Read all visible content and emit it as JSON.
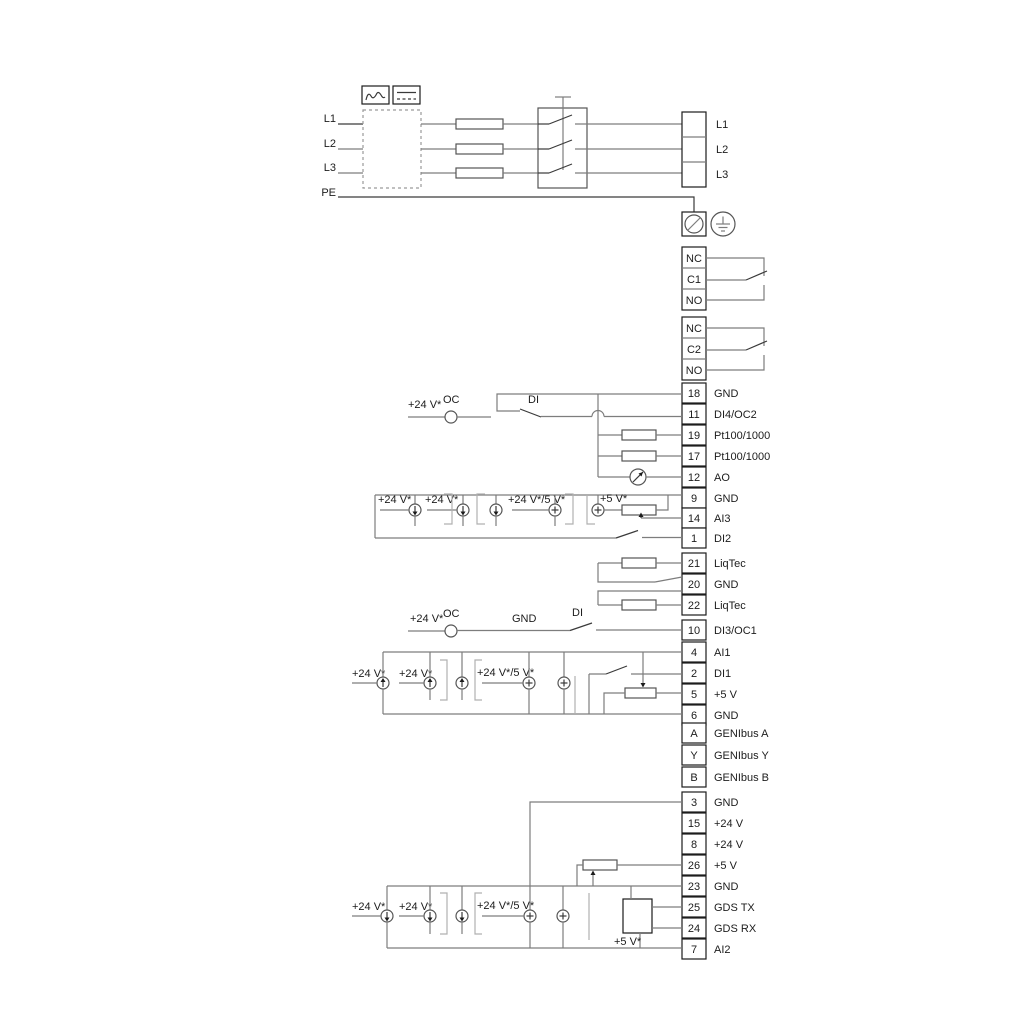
{
  "power": {
    "inputs": {
      "l1": "L1",
      "l2": "L2",
      "l3": "L3",
      "pe": "PE"
    },
    "out_terminals": {
      "l1": "L1",
      "l2": "L2",
      "l3": "L3"
    }
  },
  "relays": {
    "r1": {
      "nc": "NC",
      "c": "C1",
      "no": "NO"
    },
    "r2": {
      "nc": "NC",
      "c": "C2",
      "no": "NO"
    }
  },
  "io_terminals": [
    {
      "num": "18",
      "label": "GND"
    },
    {
      "num": "11",
      "label": "DI4/OC2"
    },
    {
      "num": "19",
      "label": "Pt100/1000"
    },
    {
      "num": "17",
      "label": "Pt100/1000"
    },
    {
      "num": "12",
      "label": "AO"
    },
    {
      "num": "9",
      "label": "GND"
    },
    {
      "num": "14",
      "label": "AI3"
    },
    {
      "num": "1",
      "label": "DI2"
    },
    {
      "num": "21",
      "label": "LiqTec"
    },
    {
      "num": "20",
      "label": "GND"
    },
    {
      "num": "22",
      "label": "LiqTec"
    },
    {
      "num": "10",
      "label": "DI3/OC1"
    },
    {
      "num": "4",
      "label": "AI1"
    },
    {
      "num": "2",
      "label": "DI1"
    },
    {
      "num": "5",
      "label": "+5 V"
    },
    {
      "num": "6",
      "label": "GND"
    },
    {
      "num": "A",
      "label": "GENIbus A"
    },
    {
      "num": "Y",
      "label": "GENIbus Y"
    },
    {
      "num": "B",
      "label": "GENIbus B"
    },
    {
      "num": "3",
      "label": "GND"
    },
    {
      "num": "15",
      "label": "+24 V"
    },
    {
      "num": "8",
      "label": "+24 V"
    },
    {
      "num": "26",
      "label": "+5 V"
    },
    {
      "num": "23",
      "label": "GND"
    },
    {
      "num": "25",
      "label": "GDS TX"
    },
    {
      "num": "24",
      "label": "GDS RX"
    },
    {
      "num": "7",
      "label": "AI2"
    }
  ],
  "annotations": {
    "v24": "+24 V*",
    "v24_5": "+24 V*/5 V*",
    "v5": "+5 V*",
    "oc": "OC",
    "di": "DI",
    "gnd": "GND"
  },
  "colors": {
    "wire": "#7d7d7d",
    "ink": "#1c1c1c"
  }
}
